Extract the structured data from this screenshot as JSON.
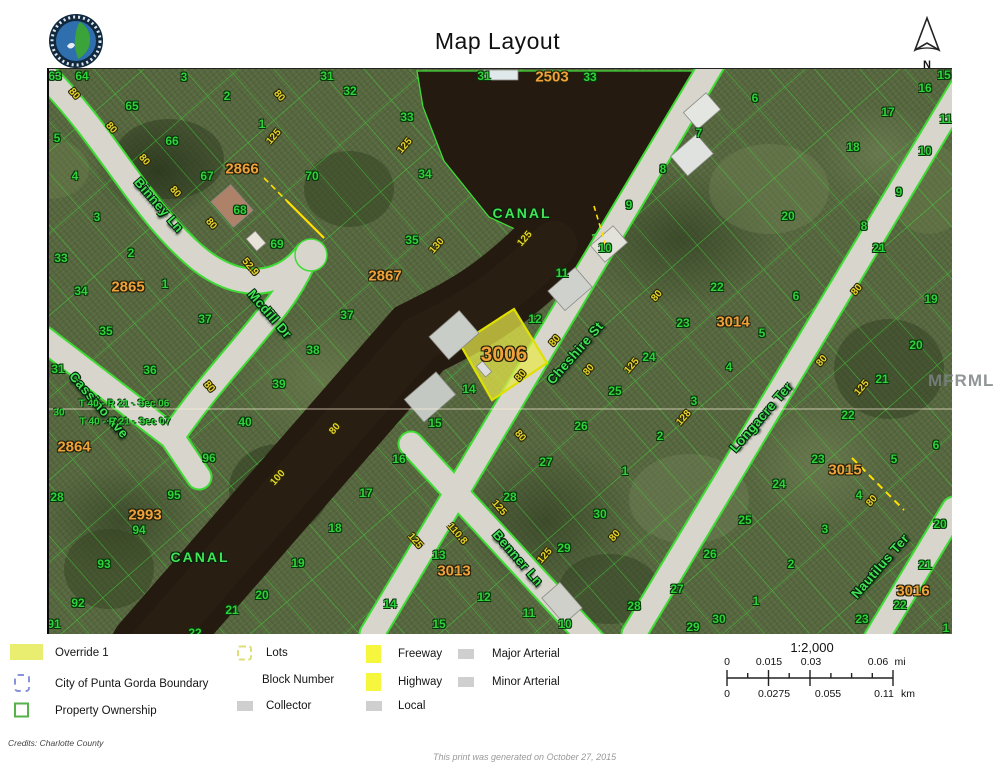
{
  "header": {
    "title": "Map Layout",
    "north_label": "N"
  },
  "colors": {
    "lot-green": "#2fd23a",
    "street-green": "#42e455",
    "block-orange": "#f0a23a",
    "dim-yellow": "#e6d42a",
    "override-yellow": "#e9ed70",
    "city-blue": "#8892dd",
    "prop-green": "#55b24a",
    "lots-yellow": "#dede7a",
    "road-gray": "#cfcfcf",
    "fw-yellow": "#f6f63e",
    "water-dark": "#241a10",
    "parcel-line": "#3fdb35"
  },
  "map": {
    "watermark": "MFRMLS",
    "highlight_parcel": {
      "id": "3006"
    },
    "canal_labels": [
      {
        "t": "CANAL",
        "x": 473,
        "y": 144
      },
      {
        "t": "CANAL",
        "x": 151,
        "y": 488
      }
    ],
    "street_labels": [
      {
        "t": "Binney Ln",
        "x": 110,
        "y": 136,
        "r": 49
      },
      {
        "t": "Mcdill Dr",
        "x": 221,
        "y": 245,
        "r": 49
      },
      {
        "t": "Cassino Ave",
        "x": 50,
        "y": 336,
        "r": 49
      },
      {
        "t": "Cheshire St",
        "x": 526,
        "y": 284,
        "r": -49
      },
      {
        "t": "Benner Ln",
        "x": 469,
        "y": 489,
        "r": 49
      },
      {
        "t": "Longacre Ter",
        "x": 712,
        "y": 348,
        "r": -49
      },
      {
        "t": "Nautilus Ter",
        "x": 831,
        "y": 497,
        "r": -49
      }
    ],
    "block_labels": [
      {
        "t": "2503",
        "x": 503,
        "y": 8
      },
      {
        "t": "2866",
        "x": 193,
        "y": 100
      },
      {
        "t": "2865",
        "x": 79,
        "y": 218
      },
      {
        "t": "2867",
        "x": 336,
        "y": 207
      },
      {
        "t": "2864",
        "x": 25,
        "y": 378
      },
      {
        "t": "2993",
        "x": 96,
        "y": 446
      },
      {
        "t": "3013",
        "x": 405,
        "y": 502
      },
      {
        "t": "3014",
        "x": 684,
        "y": 253
      },
      {
        "t": "3015",
        "x": 796,
        "y": 401
      },
      {
        "t": "3016",
        "x": 864,
        "y": 522
      },
      {
        "t": "3006",
        "x": 455,
        "y": 286,
        "big": true
      }
    ],
    "section_labels": [
      {
        "t": "T 40 - R 21 - Sec 06",
        "x": 75,
        "y": 335
      },
      {
        "t": "T 40 - R 21 - Sec 07",
        "x": 76,
        "y": 353
      },
      {
        "t": "30",
        "x": 10,
        "y": 344
      }
    ],
    "lot_labels": [
      {
        "t": "63",
        "x": 6,
        "y": 7
      },
      {
        "t": "64",
        "x": 33,
        "y": 7
      },
      {
        "t": "65",
        "x": 83,
        "y": 37
      },
      {
        "t": "66",
        "x": 123,
        "y": 72
      },
      {
        "t": "3",
        "x": 135,
        "y": 8
      },
      {
        "t": "2",
        "x": 178,
        "y": 27
      },
      {
        "t": "1",
        "x": 213,
        "y": 55
      },
      {
        "t": "67",
        "x": 158,
        "y": 107
      },
      {
        "t": "68",
        "x": 191,
        "y": 141
      },
      {
        "t": "69",
        "x": 228,
        "y": 175
      },
      {
        "t": "70",
        "x": 263,
        "y": 107
      },
      {
        "t": "5",
        "x": 8,
        "y": 69
      },
      {
        "t": "4",
        "x": 26,
        "y": 107
      },
      {
        "t": "3",
        "x": 48,
        "y": 148
      },
      {
        "t": "33",
        "x": 12,
        "y": 189
      },
      {
        "t": "2",
        "x": 82,
        "y": 184
      },
      {
        "t": "34",
        "x": 32,
        "y": 222
      },
      {
        "t": "1",
        "x": 116,
        "y": 215
      },
      {
        "t": "35",
        "x": 57,
        "y": 262
      },
      {
        "t": "31",
        "x": 278,
        "y": 7
      },
      {
        "t": "32",
        "x": 301,
        "y": 22
      },
      {
        "t": "33",
        "x": 358,
        "y": 48
      },
      {
        "t": "31",
        "x": 435,
        "y": 7
      },
      {
        "t": "33",
        "x": 541,
        "y": 8
      },
      {
        "t": "34",
        "x": 376,
        "y": 105
      },
      {
        "t": "35",
        "x": 363,
        "y": 171
      },
      {
        "t": "37",
        "x": 298,
        "y": 246
      },
      {
        "t": "38",
        "x": 264,
        "y": 281
      },
      {
        "t": "37",
        "x": 156,
        "y": 250
      },
      {
        "t": "36",
        "x": 101,
        "y": 301
      },
      {
        "t": "31",
        "x": 9,
        "y": 300
      },
      {
        "t": "39",
        "x": 230,
        "y": 315
      },
      {
        "t": "40",
        "x": 196,
        "y": 353
      },
      {
        "t": "96",
        "x": 160,
        "y": 389
      },
      {
        "t": "95",
        "x": 125,
        "y": 426
      },
      {
        "t": "94",
        "x": 90,
        "y": 461
      },
      {
        "t": "93",
        "x": 55,
        "y": 495
      },
      {
        "t": "92",
        "x": 29,
        "y": 534
      },
      {
        "t": "91",
        "x": 5,
        "y": 555
      },
      {
        "t": "28",
        "x": 8,
        "y": 428
      },
      {
        "t": "7",
        "x": 650,
        "y": 64
      },
      {
        "t": "8",
        "x": 614,
        "y": 100
      },
      {
        "t": "9",
        "x": 580,
        "y": 136
      },
      {
        "t": "10",
        "x": 556,
        "y": 179
      },
      {
        "t": "11",
        "x": 513,
        "y": 204
      },
      {
        "t": "12",
        "x": 486,
        "y": 250
      },
      {
        "t": "14",
        "x": 420,
        "y": 320
      },
      {
        "t": "15",
        "x": 386,
        "y": 354
      },
      {
        "t": "16",
        "x": 350,
        "y": 390
      },
      {
        "t": "17",
        "x": 317,
        "y": 424
      },
      {
        "t": "18",
        "x": 286,
        "y": 459
      },
      {
        "t": "19",
        "x": 249,
        "y": 494
      },
      {
        "t": "20",
        "x": 213,
        "y": 526
      },
      {
        "t": "21",
        "x": 183,
        "y": 541
      },
      {
        "t": "22",
        "x": 146,
        "y": 564
      },
      {
        "t": "6",
        "x": 706,
        "y": 29
      },
      {
        "t": "15",
        "x": 895,
        "y": 6
      },
      {
        "t": "16",
        "x": 876,
        "y": 19
      },
      {
        "t": "17",
        "x": 839,
        "y": 43
      },
      {
        "t": "11",
        "x": 897,
        "y": 50
      },
      {
        "t": "18",
        "x": 804,
        "y": 78
      },
      {
        "t": "10",
        "x": 876,
        "y": 82
      },
      {
        "t": "9",
        "x": 850,
        "y": 123
      },
      {
        "t": "8",
        "x": 815,
        "y": 157
      },
      {
        "t": "20",
        "x": 739,
        "y": 147
      },
      {
        "t": "21",
        "x": 830,
        "y": 179
      },
      {
        "t": "22",
        "x": 668,
        "y": 218
      },
      {
        "t": "23",
        "x": 634,
        "y": 254
      },
      {
        "t": "24",
        "x": 600,
        "y": 288
      },
      {
        "t": "25",
        "x": 566,
        "y": 322
      },
      {
        "t": "26",
        "x": 532,
        "y": 357
      },
      {
        "t": "6",
        "x": 747,
        "y": 227
      },
      {
        "t": "5",
        "x": 713,
        "y": 264
      },
      {
        "t": "4",
        "x": 680,
        "y": 298
      },
      {
        "t": "3",
        "x": 645,
        "y": 332
      },
      {
        "t": "2",
        "x": 611,
        "y": 367
      },
      {
        "t": "1",
        "x": 576,
        "y": 402
      },
      {
        "t": "19",
        "x": 882,
        "y": 230
      },
      {
        "t": "20",
        "x": 867,
        "y": 276
      },
      {
        "t": "21",
        "x": 833,
        "y": 310
      },
      {
        "t": "22",
        "x": 799,
        "y": 346
      },
      {
        "t": "23",
        "x": 769,
        "y": 390
      },
      {
        "t": "24",
        "x": 730,
        "y": 415
      },
      {
        "t": "25",
        "x": 696,
        "y": 451
      },
      {
        "t": "26",
        "x": 661,
        "y": 485
      },
      {
        "t": "27",
        "x": 628,
        "y": 520
      },
      {
        "t": "30",
        "x": 670,
        "y": 550
      },
      {
        "t": "29",
        "x": 644,
        "y": 558
      },
      {
        "t": "6",
        "x": 887,
        "y": 376
      },
      {
        "t": "5",
        "x": 845,
        "y": 390
      },
      {
        "t": "4",
        "x": 810,
        "y": 426
      },
      {
        "t": "3",
        "x": 776,
        "y": 460
      },
      {
        "t": "2",
        "x": 742,
        "y": 495
      },
      {
        "t": "1",
        "x": 707,
        "y": 532
      },
      {
        "t": "20",
        "x": 891,
        "y": 455
      },
      {
        "t": "21",
        "x": 876,
        "y": 496
      },
      {
        "t": "22",
        "x": 851,
        "y": 536
      },
      {
        "t": "23",
        "x": 813,
        "y": 550
      },
      {
        "t": "1",
        "x": 897,
        "y": 559
      },
      {
        "t": "27",
        "x": 497,
        "y": 393
      },
      {
        "t": "28",
        "x": 461,
        "y": 428
      },
      {
        "t": "29",
        "x": 515,
        "y": 479
      },
      {
        "t": "30",
        "x": 551,
        "y": 445
      },
      {
        "t": "13",
        "x": 390,
        "y": 486
      },
      {
        "t": "12",
        "x": 435,
        "y": 528
      },
      {
        "t": "14",
        "x": 341,
        "y": 535
      },
      {
        "t": "15",
        "x": 390,
        "y": 555
      },
      {
        "t": "11",
        "x": 480,
        "y": 544
      },
      {
        "t": "10",
        "x": 516,
        "y": 555
      },
      {
        "t": "28",
        "x": 585,
        "y": 537
      }
    ],
    "dim_labels": [
      {
        "t": "80",
        "x": 25,
        "y": 25,
        "r": 49
      },
      {
        "t": "80",
        "x": 62,
        "y": 59,
        "r": 49
      },
      {
        "t": "80",
        "x": 95,
        "y": 91,
        "r": 49
      },
      {
        "t": "80",
        "x": 126,
        "y": 123,
        "r": 49
      },
      {
        "t": "80",
        "x": 162,
        "y": 155,
        "r": 49
      },
      {
        "t": "80",
        "x": 230,
        "y": 27,
        "r": 49
      },
      {
        "t": "125",
        "x": 225,
        "y": 68,
        "r": -49
      },
      {
        "t": "52.9",
        "x": 201,
        "y": 198,
        "r": 49
      },
      {
        "t": "100",
        "x": 229,
        "y": 409,
        "r": -49
      },
      {
        "t": "130",
        "x": 388,
        "y": 177,
        "r": -49
      },
      {
        "t": "125",
        "x": 356,
        "y": 77,
        "r": -49
      },
      {
        "t": "80",
        "x": 506,
        "y": 272,
        "r": -49
      },
      {
        "t": "80",
        "x": 472,
        "y": 307,
        "r": -49
      },
      {
        "t": "80",
        "x": 540,
        "y": 301,
        "r": -49
      },
      {
        "t": "125",
        "x": 583,
        "y": 297,
        "r": -49
      },
      {
        "t": "80",
        "x": 808,
        "y": 221,
        "r": -49
      },
      {
        "t": "80",
        "x": 773,
        "y": 292,
        "r": -49
      },
      {
        "t": "125",
        "x": 813,
        "y": 319,
        "r": -49
      },
      {
        "t": "128",
        "x": 635,
        "y": 349,
        "r": -49
      },
      {
        "t": "110.8",
        "x": 408,
        "y": 465,
        "r": 49
      },
      {
        "t": "125",
        "x": 366,
        "y": 472,
        "r": 49
      },
      {
        "t": "125",
        "x": 450,
        "y": 439,
        "r": 49
      },
      {
        "t": "80",
        "x": 471,
        "y": 367,
        "r": 49
      },
      {
        "t": "80",
        "x": 566,
        "y": 467,
        "r": -49
      },
      {
        "t": "125",
        "x": 496,
        "y": 487,
        "r": -49
      },
      {
        "t": "80",
        "x": 823,
        "y": 432,
        "r": -49
      },
      {
        "t": "80",
        "x": 608,
        "y": 227,
        "r": -49
      },
      {
        "t": "80",
        "x": 160,
        "y": 318,
        "r": 49
      },
      {
        "t": "80",
        "x": 286,
        "y": 360,
        "r": -49
      },
      {
        "t": "125",
        "x": 476,
        "y": 170,
        "r": -49
      }
    ]
  },
  "legend": {
    "override": "Override 1",
    "city": "City of Punta Gorda Boundary",
    "property": "Property Ownership",
    "lots": "Lots",
    "block_number": "Block Number",
    "collector": "Collector",
    "freeway": "Freeway",
    "highway": "Highway",
    "local": "Local",
    "major_arterial": "Major Arterial",
    "minor_arterial": "Minor Arterial"
  },
  "scalebar": {
    "ratio": "1:2,000",
    "mi": [
      "0",
      "0.015",
      "0.03",
      "0.06"
    ],
    "mi_unit": "mi",
    "km": [
      "0",
      "0.0275",
      "0.055",
      "0.11"
    ],
    "km_unit": "km"
  },
  "footer": {
    "credits": "Credits: Charlotte County",
    "generated": "This print was generated on October 27, 2015"
  }
}
